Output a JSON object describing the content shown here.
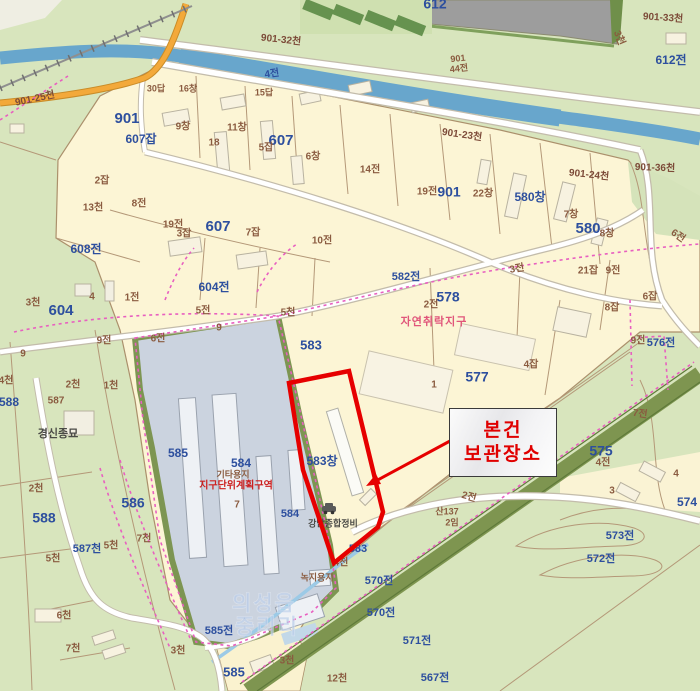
{
  "annotation": {
    "line1": "본건",
    "line2": "보관장소"
  },
  "watermark": {
    "line1": "의성읍",
    "line2": "중리리"
  },
  "poi": {
    "repair_shop": "강남종합정비",
    "seed_company": "경신종묘"
  },
  "zones": {
    "natural_settlement": "자연취락지구",
    "district_unit_plan": "지구단위계획구역",
    "other_land_use": "기타용지",
    "green_land_use": "녹지용지"
  },
  "colors": {
    "subject_outline": "#e60000",
    "annotation_text": "#e00000",
    "parcel_blue": "#2d4f9e",
    "parcel_brown": "#8a5b40",
    "village_fill": "#fcf5d5",
    "field_green": "#d8e5bd",
    "river_blue": "#68a6cc",
    "factory_fill": "#cbd3df",
    "road_orange": "#f3a93a",
    "zone_dash_pink": "#e85fc0",
    "tree_band_green": "#7e9550"
  },
  "map": {
    "labels": [
      {
        "t": "901-25천",
        "x": 35,
        "y": 99,
        "c": "br2",
        "s": 10,
        "r": -12
      },
      {
        "t": "901",
        "x": 127,
        "y": 119,
        "c": "b",
        "s": 15
      },
      {
        "t": "607잡",
        "x": 141,
        "y": 140,
        "c": "b",
        "s": 12
      },
      {
        "t": "9창",
        "x": 183,
        "y": 127,
        "c": "br",
        "s": 10
      },
      {
        "t": "11창",
        "x": 237,
        "y": 128,
        "c": "br",
        "s": 10
      },
      {
        "t": "18",
        "x": 214,
        "y": 143,
        "c": "br",
        "s": 10
      },
      {
        "t": "607",
        "x": 281,
        "y": 141,
        "c": "b",
        "s": 15
      },
      {
        "t": "5잡",
        "x": 266,
        "y": 148,
        "c": "br",
        "s": 10
      },
      {
        "t": "6창",
        "x": 313,
        "y": 157,
        "c": "br",
        "s": 10
      },
      {
        "t": "2잡",
        "x": 102,
        "y": 181,
        "c": "br",
        "s": 10
      },
      {
        "t": "8전",
        "x": 139,
        "y": 204,
        "c": "br",
        "s": 10
      },
      {
        "t": "13천",
        "x": 93,
        "y": 208,
        "c": "br",
        "s": 10
      },
      {
        "t": "19전",
        "x": 173,
        "y": 225,
        "c": "br",
        "s": 10
      },
      {
        "t": "3잡",
        "x": 184,
        "y": 234,
        "c": "br",
        "s": 10
      },
      {
        "t": "607",
        "x": 218,
        "y": 227,
        "c": "b",
        "s": 15
      },
      {
        "t": "7잡",
        "x": 253,
        "y": 233,
        "c": "br",
        "s": 10
      },
      {
        "t": "10전",
        "x": 322,
        "y": 241,
        "c": "br",
        "s": 10
      },
      {
        "t": "30답",
        "x": 156,
        "y": 89,
        "c": "br",
        "s": 9
      },
      {
        "t": "16창",
        "x": 188,
        "y": 89,
        "c": "br",
        "s": 9
      },
      {
        "t": "15답",
        "x": 264,
        "y": 93,
        "c": "br",
        "s": 9
      },
      {
        "t": "4전",
        "x": 272,
        "y": 74,
        "c": "b",
        "s": 10,
        "r": -8
      },
      {
        "t": "901-32천",
        "x": 281,
        "y": 40,
        "c": "br2",
        "s": 10,
        "r": 6
      },
      {
        "t": "612",
        "x": 435,
        "y": 5,
        "c": "b",
        "s": 14
      },
      {
        "t": "901",
        "x": 458,
        "y": 59,
        "c": "br",
        "s": 9,
        "r": -6
      },
      {
        "t": "44전",
        "x": 459,
        "y": 69,
        "c": "br",
        "s": 9,
        "r": -6
      },
      {
        "t": "3천",
        "x": 619,
        "y": 38,
        "c": "br",
        "s": 10,
        "r": 68
      },
      {
        "t": "901-33천",
        "x": 663,
        "y": 18,
        "c": "br2",
        "s": 10,
        "r": 4
      },
      {
        "t": "612전",
        "x": 671,
        "y": 61,
        "c": "b",
        "s": 12
      },
      {
        "t": "901-23천",
        "x": 462,
        "y": 135,
        "c": "br2",
        "s": 10,
        "r": 8
      },
      {
        "t": "901-24천",
        "x": 589,
        "y": 175,
        "c": "br2",
        "s": 10,
        "r": 6
      },
      {
        "t": "901-36천",
        "x": 655,
        "y": 168,
        "c": "br2",
        "s": 10,
        "r": 2
      },
      {
        "t": "14전",
        "x": 370,
        "y": 170,
        "c": "br",
        "s": 10
      },
      {
        "t": "19전",
        "x": 427,
        "y": 192,
        "c": "br",
        "s": 10
      },
      {
        "t": "901",
        "x": 449,
        "y": 193,
        "c": "b",
        "s": 14
      },
      {
        "t": "22창",
        "x": 483,
        "y": 194,
        "c": "br",
        "s": 10
      },
      {
        "t": "580창",
        "x": 530,
        "y": 198,
        "c": "b",
        "s": 12
      },
      {
        "t": "7창",
        "x": 571,
        "y": 215,
        "c": "br",
        "s": 10
      },
      {
        "t": "580",
        "x": 588,
        "y": 229,
        "c": "b",
        "s": 15
      },
      {
        "t": "8창",
        "x": 607,
        "y": 234,
        "c": "br",
        "s": 10
      },
      {
        "t": "21잡",
        "x": 588,
        "y": 271,
        "c": "br",
        "s": 10
      },
      {
        "t": "9전",
        "x": 613,
        "y": 271,
        "c": "br",
        "s": 10
      },
      {
        "t": "6전",
        "x": 678,
        "y": 236,
        "c": "br",
        "s": 10,
        "r": 35
      },
      {
        "t": "6잡",
        "x": 650,
        "y": 297,
        "c": "br",
        "s": 10
      },
      {
        "t": "8잡",
        "x": 612,
        "y": 308,
        "c": "br",
        "s": 10
      },
      {
        "t": "3전",
        "x": 517,
        "y": 269,
        "c": "br",
        "s": 10,
        "r": -10
      },
      {
        "t": "582전",
        "x": 406,
        "y": 277,
        "c": "b",
        "s": 11
      },
      {
        "t": "2전",
        "x": 431,
        "y": 305,
        "c": "br",
        "s": 10
      },
      {
        "t": "578",
        "x": 448,
        "y": 298,
        "c": "b",
        "s": 14
      },
      {
        "t": "자연취락지구",
        "x": 434,
        "y": 322,
        "c": "pk",
        "s": 11
      },
      {
        "t": "577",
        "x": 477,
        "y": 378,
        "c": "b",
        "s": 14
      },
      {
        "t": "1",
        "x": 434,
        "y": 385,
        "c": "br",
        "s": 10
      },
      {
        "t": "4잡",
        "x": 531,
        "y": 365,
        "c": "br",
        "s": 10
      },
      {
        "t": "9전",
        "x": 638,
        "y": 341,
        "c": "br",
        "s": 10
      },
      {
        "t": "576전",
        "x": 661,
        "y": 343,
        "c": "b",
        "s": 11
      },
      {
        "t": "583",
        "x": 311,
        "y": 346,
        "c": "b",
        "s": 13
      },
      {
        "t": "604전",
        "x": 214,
        "y": 288,
        "c": "b",
        "s": 12
      },
      {
        "t": "608전",
        "x": 86,
        "y": 250,
        "c": "b",
        "s": 12
      },
      {
        "t": "604",
        "x": 61,
        "y": 311,
        "c": "b",
        "s": 15
      },
      {
        "t": "3천",
        "x": 33,
        "y": 303,
        "c": "br",
        "s": 10
      },
      {
        "t": "4",
        "x": 92,
        "y": 297,
        "c": "br",
        "s": 10
      },
      {
        "t": "1전",
        "x": 132,
        "y": 298,
        "c": "br",
        "s": 10
      },
      {
        "t": "9전",
        "x": 104,
        "y": 341,
        "c": "br",
        "s": 10
      },
      {
        "t": "6전",
        "x": 158,
        "y": 339,
        "c": "br",
        "s": 10
      },
      {
        "t": "5전",
        "x": 203,
        "y": 311,
        "c": "br",
        "s": 10
      },
      {
        "t": "9",
        "x": 219,
        "y": 328,
        "c": "br",
        "s": 10
      },
      {
        "t": "5천",
        "x": 288,
        "y": 313,
        "c": "br",
        "s": 10
      },
      {
        "t": "9",
        "x": 23,
        "y": 354,
        "c": "br",
        "s": 10
      },
      {
        "t": "4천",
        "x": 6,
        "y": 381,
        "c": "br",
        "s": 10
      },
      {
        "t": "2천",
        "x": 73,
        "y": 385,
        "c": "br",
        "s": 10
      },
      {
        "t": "1천",
        "x": 111,
        "y": 386,
        "c": "br",
        "s": 10
      },
      {
        "t": "588",
        "x": 9,
        "y": 403,
        "c": "b",
        "s": 12
      },
      {
        "t": "587",
        "x": 56,
        "y": 401,
        "c": "br",
        "s": 10
      },
      {
        "t": "경신종묘",
        "x": 58,
        "y": 434,
        "c": "dk",
        "s": 11
      },
      {
        "t": "585",
        "x": 178,
        "y": 454,
        "c": "b",
        "s": 12
      },
      {
        "t": "7",
        "x": 237,
        "y": 505,
        "c": "br",
        "s": 10
      },
      {
        "t": "584",
        "x": 241,
        "y": 464,
        "c": "b",
        "s": 12
      },
      {
        "t": "기타용지",
        "x": 233,
        "y": 475,
        "c": "br",
        "s": 9
      },
      {
        "t": "지구단위계획구역",
        "x": 236,
        "y": 486,
        "c": "rd",
        "s": 10
      },
      {
        "t": "584",
        "x": 290,
        "y": 514,
        "c": "b",
        "s": 11
      },
      {
        "t": "583창",
        "x": 322,
        "y": 462,
        "c": "b",
        "s": 12
      },
      {
        "t": "2천",
        "x": 36,
        "y": 489,
        "c": "br",
        "s": 10
      },
      {
        "t": "588",
        "x": 44,
        "y": 519,
        "c": "b",
        "s": 14
      },
      {
        "t": "586",
        "x": 133,
        "y": 504,
        "c": "b",
        "s": 14
      },
      {
        "t": "587천",
        "x": 87,
        "y": 549,
        "c": "b",
        "s": 11
      },
      {
        "t": "5천",
        "x": 111,
        "y": 546,
        "c": "br",
        "s": 10
      },
      {
        "t": "7천",
        "x": 144,
        "y": 539,
        "c": "br",
        "s": 10
      },
      {
        "t": "5천",
        "x": 53,
        "y": 559,
        "c": "br",
        "s": 10
      },
      {
        "t": "6천",
        "x": 64,
        "y": 616,
        "c": "br",
        "s": 10
      },
      {
        "t": "7천",
        "x": 73,
        "y": 649,
        "c": "br",
        "s": 10
      },
      {
        "t": "3천",
        "x": 178,
        "y": 651,
        "c": "br",
        "s": 10
      },
      {
        "t": "585전",
        "x": 219,
        "y": 631,
        "c": "b",
        "s": 11
      },
      {
        "t": "585",
        "x": 234,
        "y": 673,
        "c": "b",
        "s": 13
      },
      {
        "t": "12천",
        "x": 337,
        "y": 679,
        "c": "br",
        "s": 10
      },
      {
        "t": "3천",
        "x": 287,
        "y": 661,
        "c": "br",
        "s": 10
      },
      {
        "t": "녹지용지",
        "x": 317,
        "y": 578,
        "c": "br",
        "s": 9
      },
      {
        "t": "583",
        "x": 358,
        "y": 549,
        "c": "b",
        "s": 11
      },
      {
        "t": "4천",
        "x": 341,
        "y": 563,
        "c": "br",
        "s": 10
      },
      {
        "t": "강남종합정비",
        "x": 333,
        "y": 524,
        "c": "dk",
        "s": 9
      },
      {
        "t": "산137",
        "x": 447,
        "y": 512,
        "c": "br",
        "s": 9
      },
      {
        "t": "2임",
        "x": 452,
        "y": 523,
        "c": "br",
        "s": 9
      },
      {
        "t": "2전",
        "x": 469,
        "y": 497,
        "c": "br",
        "s": 10,
        "r": 15
      },
      {
        "t": "7전",
        "x": 640,
        "y": 414,
        "c": "br",
        "s": 10,
        "r": 8
      },
      {
        "t": "575",
        "x": 601,
        "y": 452,
        "c": "b",
        "s": 14
      },
      {
        "t": "4전",
        "x": 603,
        "y": 463,
        "c": "br",
        "s": 10
      },
      {
        "t": "3",
        "x": 612,
        "y": 491,
        "c": "br",
        "s": 10
      },
      {
        "t": "4",
        "x": 676,
        "y": 474,
        "c": "br",
        "s": 10
      },
      {
        "t": "574",
        "x": 687,
        "y": 503,
        "c": "b",
        "s": 12
      },
      {
        "t": "573전",
        "x": 620,
        "y": 536,
        "c": "b",
        "s": 11
      },
      {
        "t": "572전",
        "x": 601,
        "y": 559,
        "c": "b",
        "s": 11
      },
      {
        "t": "570전",
        "x": 379,
        "y": 581,
        "c": "b",
        "s": 11
      },
      {
        "t": "570전",
        "x": 381,
        "y": 613,
        "c": "b",
        "s": 11
      },
      {
        "t": "571전",
        "x": 417,
        "y": 641,
        "c": "b",
        "s": 11
      },
      {
        "t": "567전",
        "x": 435,
        "y": 678,
        "c": "b",
        "s": 11
      },
      {
        "t": "의성읍",
        "x": 264,
        "y": 605,
        "c": "wm",
        "s": 21
      },
      {
        "t": "중리리",
        "x": 267,
        "y": 628,
        "c": "wm",
        "s": 21
      }
    ]
  }
}
